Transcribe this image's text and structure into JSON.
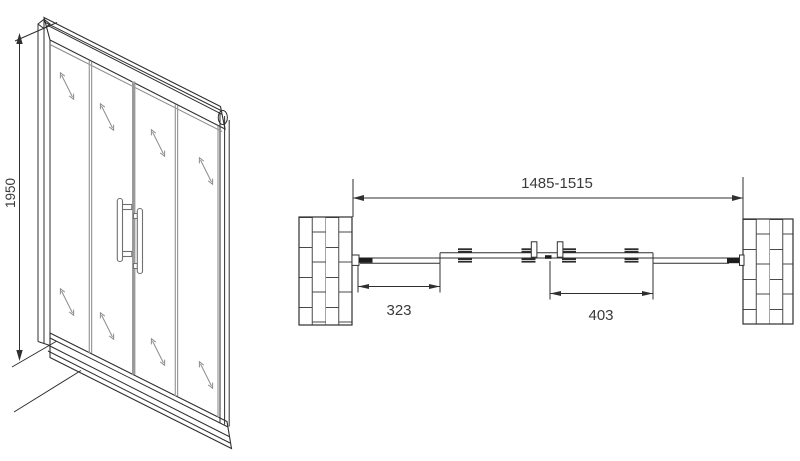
{
  "front_view": {
    "height_label": "1950"
  },
  "plan_view": {
    "overall_width_label": "1485-1515",
    "left_panel_label": "323",
    "right_panel_label": "403"
  },
  "colors": {
    "line": "#2f2f2f",
    "text": "#3a3a3a",
    "background": "#ffffff"
  }
}
